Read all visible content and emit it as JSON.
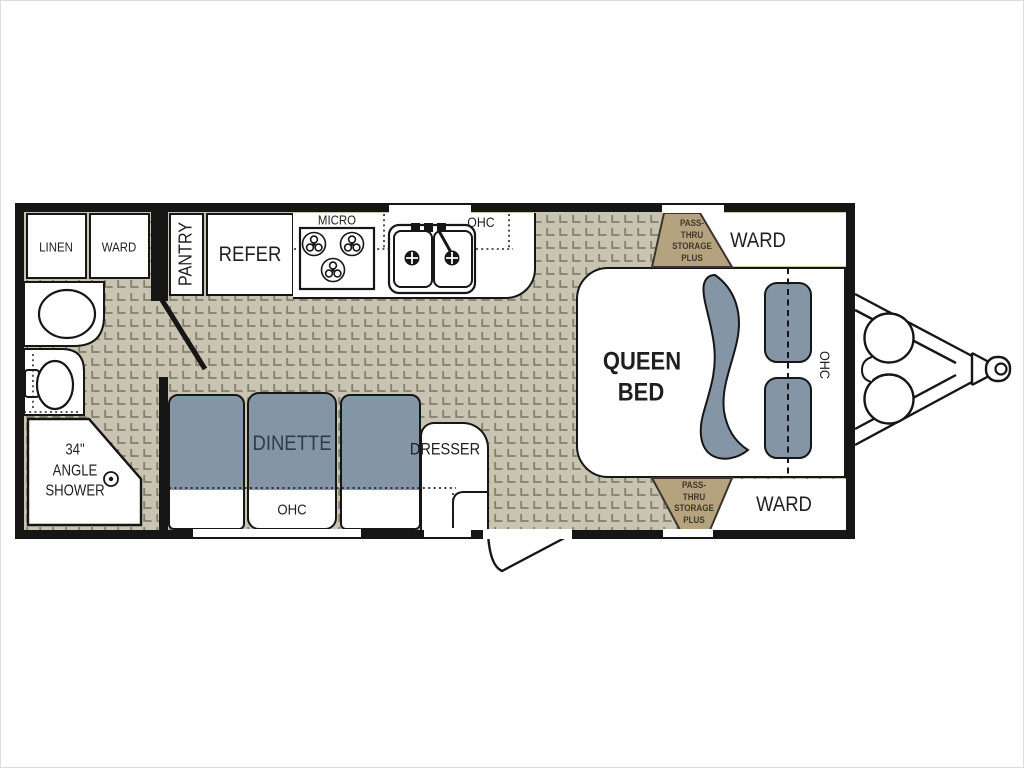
{
  "colors": {
    "page_bg": "#ffffff",
    "wall": "#161616",
    "tile_base": "#c9c3b1",
    "tile_line": "#847e6d",
    "furniture_blue": "#8496a6",
    "storage_tan": "#b5a37f",
    "storage_text": "#40382a",
    "dinette_text": "#2f3b46",
    "label": "#1f1f1f"
  },
  "rooms": {
    "linen": "LINEN",
    "ward_front": "WARD",
    "pantry": "PANTRY",
    "refer": "REFER",
    "micro": "MICRO",
    "kitchen_ohc": "OHC",
    "storage": {
      "lines": [
        "PASS-",
        "THRU",
        "STORAGE",
        "PLUS"
      ]
    },
    "ward_rear_top": "WARD",
    "bed": {
      "lines": [
        "QUEEN",
        "BED"
      ]
    },
    "bed_ohc": "OHC",
    "dinette": "DINETTE",
    "dinette_ohc": "OHC",
    "dresser": "DRESSER",
    "shower": {
      "lines": [
        "34\"",
        "ANGLE",
        "SHOWER"
      ]
    },
    "ward_rear_bottom": "WARD"
  }
}
